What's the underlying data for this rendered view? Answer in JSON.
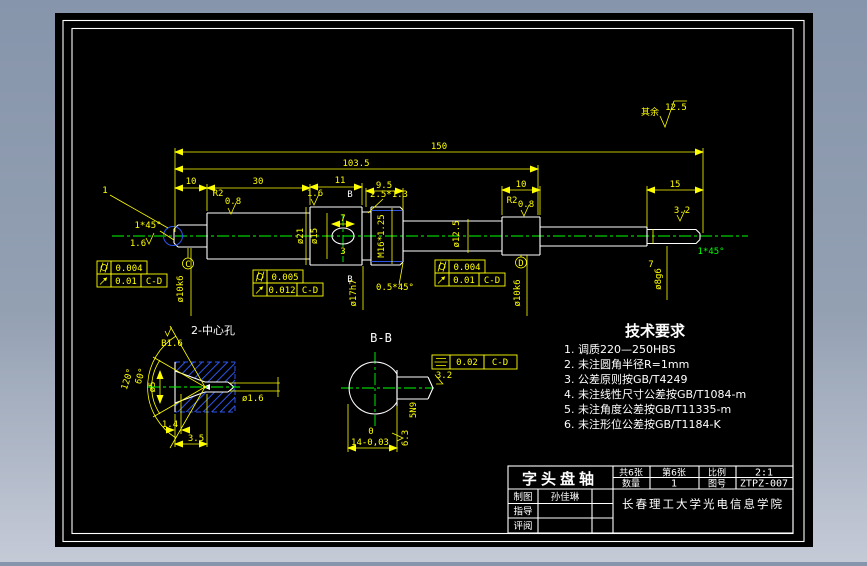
{
  "app": {
    "viewer_bg_top": "#8795ac",
    "viewer_bg_bottom": "#c5cad7",
    "canvas_bg": "#000000"
  },
  "colors": {
    "outline": "#ffffff",
    "dimension": "#ffff00",
    "centerline": "#00ff00",
    "auxiliary_blue": "#2d55e8"
  },
  "surface_note": {
    "prefix": "其余",
    "value": "12.5"
  },
  "tech_requirements": {
    "title": "技术要求",
    "items": [
      "1. 调质220—250HBS",
      "2. 未注圆角半径R=1mm",
      "3. 公差原则按GB/T4249",
      "4. 未注线性尺寸公差按GB/T1084-m",
      "5. 未注角度公差按GB/T11335-m",
      "6. 未注形位公差按GB/T1184-K"
    ]
  },
  "front_view": {
    "balloon": "1",
    "len150": "150",
    "len103_5": "103.5",
    "len10_left": "10",
    "len30": "30",
    "len11": "11",
    "len9_5": "9.5",
    "groove": "2.5*1.3",
    "len10_right": "10",
    "len15": "15",
    "len7_right": "7",
    "kw_len7": "7",
    "kw_depth3": "3",
    "r2_left": "R2",
    "r2_right": "R2",
    "rough08_left": "0.8",
    "rough08_right": "0.8",
    "rough16_keyway": "1.6",
    "rough16_end": "1.6",
    "rough32_right": "3.2",
    "chamfer_left": "1*45°",
    "chamfer_right": "1*45°",
    "chamfer_thread": "0.5*45°",
    "dia15": "ø15",
    "dia21": "ø21",
    "thread": "M16*1.25",
    "dia17h7": "ø17h7",
    "dia12_5": "ø12.5",
    "dia10k6_left": "ø10k6",
    "dia10k6_right": "ø10k6",
    "dia8g6": "ø8g6",
    "section_marker_top": "B",
    "section_marker_bottom": "B"
  },
  "gdt": {
    "left": {
      "cyl": "0.004",
      "runout": "0.01",
      "datum": "C-D"
    },
    "middle": {
      "cyl": "0.005",
      "runout": "0.012",
      "datum": "C-D"
    },
    "right": {
      "cyl": "0.004",
      "runout": "0.01",
      "datum": "C-D"
    }
  },
  "datums": {
    "c": "C",
    "d": "D"
  },
  "section_view": {
    "title": "B-B",
    "sym_value": "0.02",
    "sym_datum": "C-D",
    "rough_flat": "3.2",
    "rough_side": "6.3",
    "keyway_width": "5N9",
    "flat_tol_upper": "0",
    "flat_dim": "14-0,03"
  },
  "detail_view": {
    "title": "2-中心孔",
    "rough": "B1.6",
    "dia_cone": "ø5",
    "dia_pilot": "ø1.6",
    "angle_outer": "120°",
    "angle_inner": "60°",
    "len_pilot": "1.4",
    "len_total": "3.5"
  },
  "title_block": {
    "part_name": "字头盘轴",
    "sheets_total": "共6张",
    "sheet_no": "第6张",
    "scale_label": "比例",
    "scale_value": "2:1",
    "qty_label": "数量",
    "qty_value": "1",
    "dwg_no_label": "图号",
    "dwg_no_value": "ZTPZ-007",
    "drafter_label": "制图",
    "drafter_name": "孙佳琳",
    "advisor_label": "指导",
    "reviewer_label": "评阅",
    "organization": "长春理工大学光电信息学院"
  }
}
